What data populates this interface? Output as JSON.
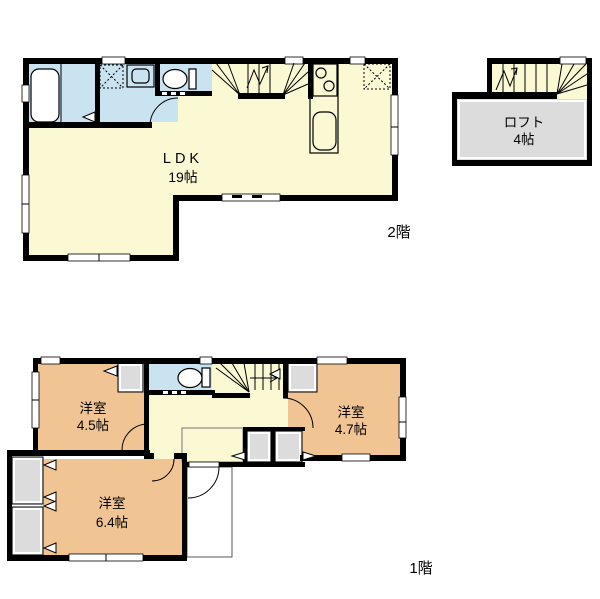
{
  "title": "間取り図",
  "floor2": {
    "label": "2階",
    "ldk_name": "LDK",
    "ldk_size": "19帖",
    "loft_name": "ロフト",
    "loft_size": "4帖"
  },
  "floor1": {
    "label": "1階",
    "room45_name": "洋室",
    "room45_size": "4.5帖",
    "room47_name": "洋室",
    "room47_size": "4.7帖",
    "room64_name": "洋室",
    "room64_size": "6.4帖"
  },
  "colors": {
    "floor_yellow": "#FBF8D4",
    "wet_blue": "#C9E3F1",
    "bedroom_orange": "#F1C593",
    "closet_gray": "#DCDCDC",
    "wall_black": "#000000"
  }
}
